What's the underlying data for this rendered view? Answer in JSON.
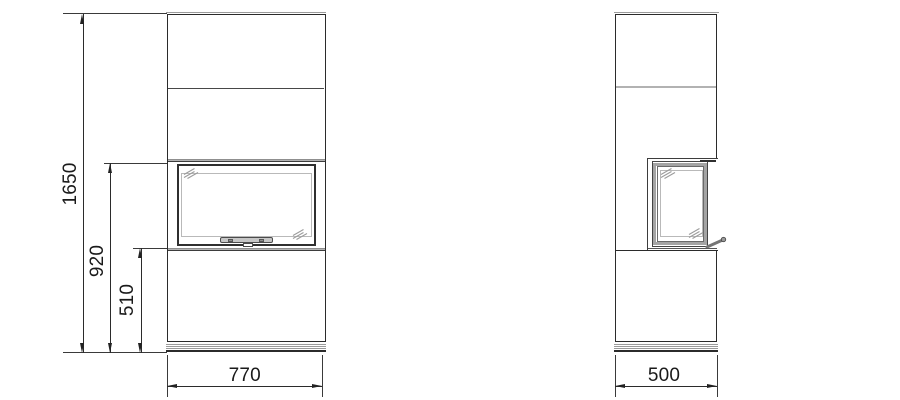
{
  "drawing": {
    "dimensions": {
      "total_height": "1650",
      "firebox_top_height": "920",
      "firebox_bottom_height": "510",
      "front_width": "770",
      "side_depth": "500"
    },
    "colors": {
      "line": "#2b2b2b",
      "light_gray_band": "#b3b3b3",
      "glass_line": "#b9b9b9",
      "hatch": "#9c9c9c",
      "background": "#ffffff"
    }
  }
}
